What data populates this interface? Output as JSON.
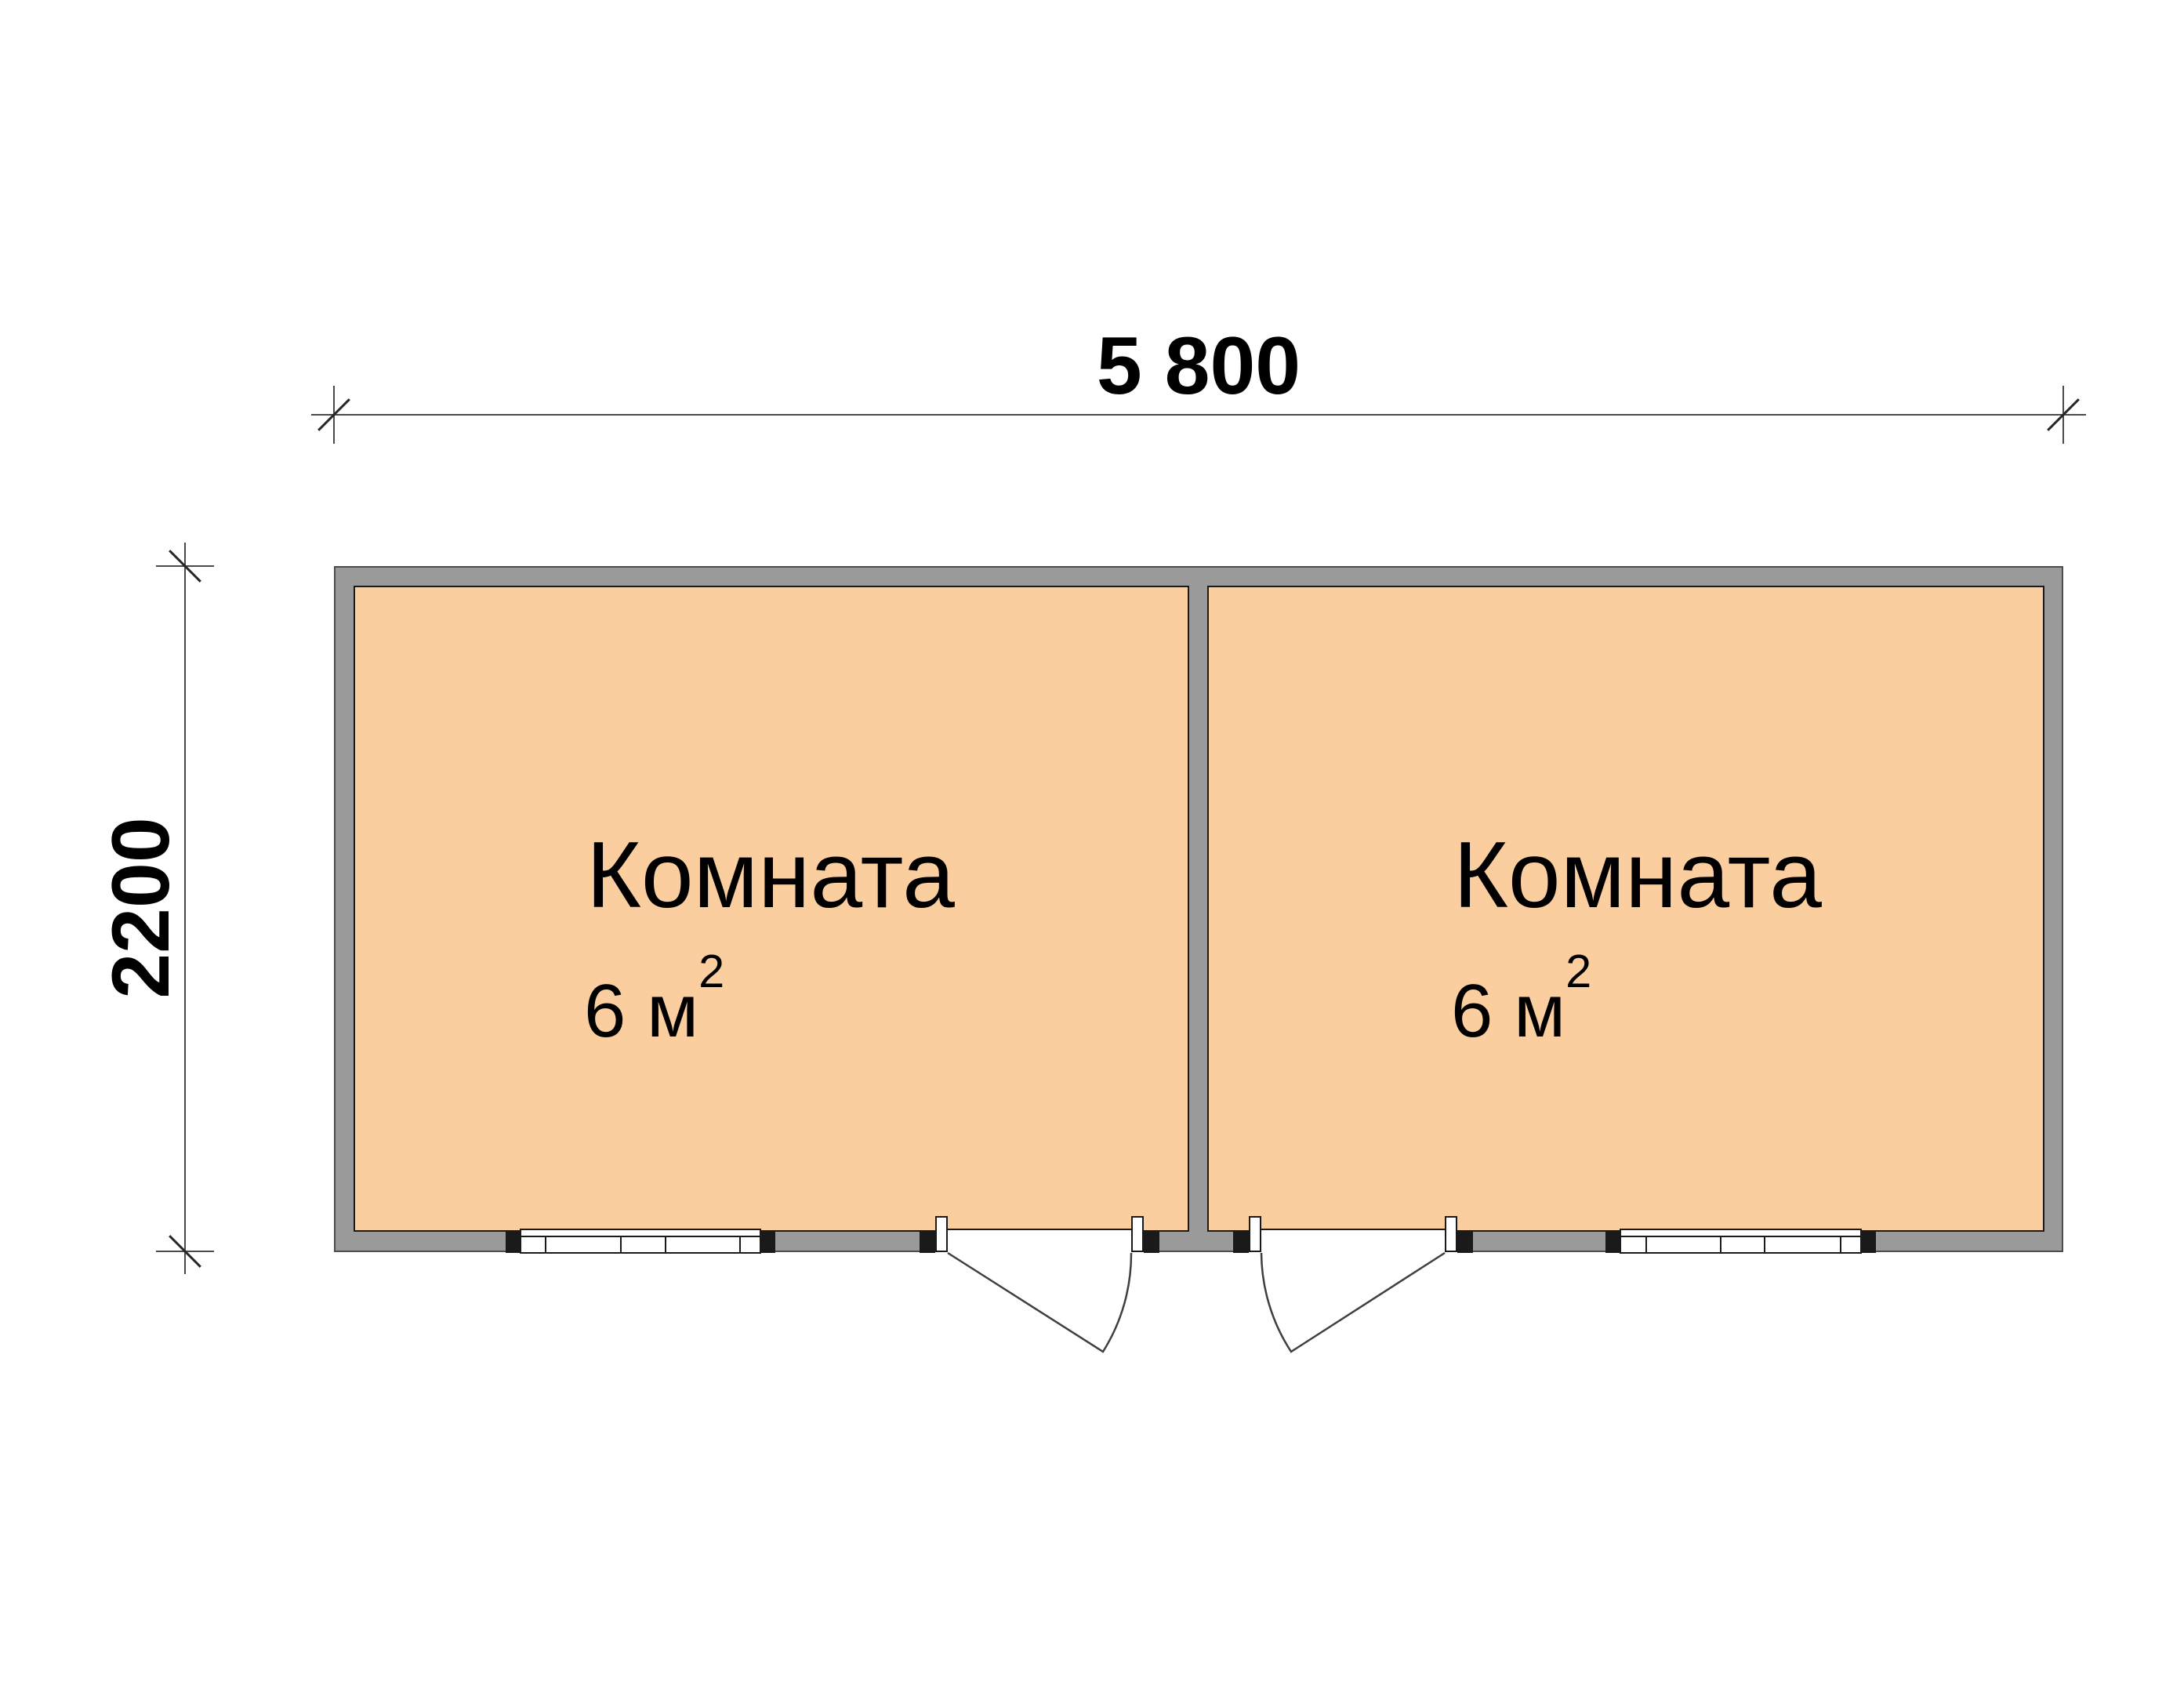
{
  "title": "Floor plan — cabin with two rooms",
  "colors": {
    "room_fill": "#FBCEA0",
    "wall": "#9A9A9A",
    "outline": "#1A1A1A",
    "dim_line": "#4A4A4A",
    "text": "#000000"
  },
  "dimensions": {
    "width_label": "5 800",
    "height_label": "2200"
  },
  "rooms": [
    {
      "name": "Комната",
      "area_value": "6 м",
      "area_sup": "2"
    },
    {
      "name": "Комната",
      "area_value": "6 м",
      "area_sup": "2"
    }
  ]
}
